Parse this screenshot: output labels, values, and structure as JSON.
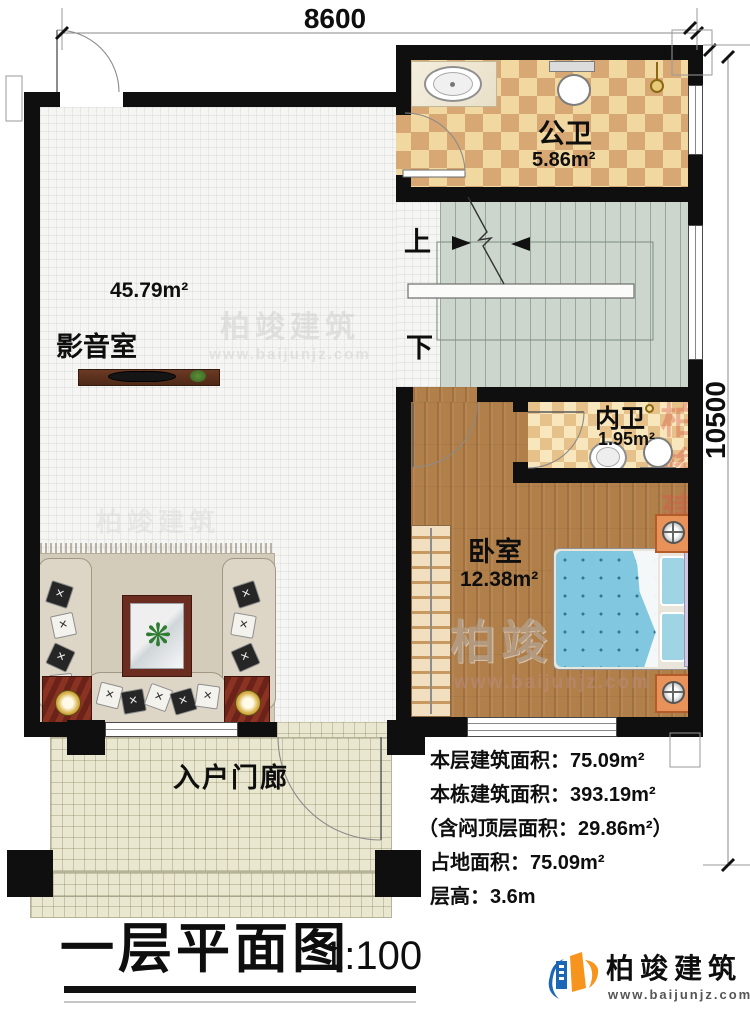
{
  "dimensions": {
    "top": "8600",
    "right": "10500"
  },
  "rooms": {
    "media": {
      "name": "影音室",
      "area": "45.79m²"
    },
    "public_bath": {
      "name": "公卫",
      "area": "5.86m²"
    },
    "inner_bath": {
      "name": "内卫",
      "area": "1.95m²"
    },
    "bedroom": {
      "name": "卧室",
      "area": "12.38m²"
    },
    "porch": {
      "name": "入户门廊"
    }
  },
  "stairs": {
    "up": "上",
    "down": "下"
  },
  "stats": {
    "lines": [
      "本层建筑面积：75.09m²",
      "本栋建筑面积：393.19m²",
      "（含闷顶层面积：29.86m²）",
      "占地面积：75.09m²",
      "层高：3.6m"
    ]
  },
  "title": {
    "text": "一层平面图",
    "scale": "1:100"
  },
  "brand": {
    "name": "柏竣建筑",
    "url": "www.baijunjz.com"
  },
  "watermark": {
    "name": "柏竣建筑",
    "url": "www.baijunjz.com",
    "short": "建筑"
  },
  "colors": {
    "wall": "#0f0f0f",
    "tile_tan": "#d8a874",
    "tile_cream": "#f1d7a0",
    "wood": "#b1804a",
    "stair": "#ccd6cc",
    "porch": "#eae7d1",
    "bed_blue": "#82c7e0",
    "logo_blue": "#1b66b5",
    "logo_orange": "#f7941d",
    "watermark_red": "#d9564a"
  }
}
